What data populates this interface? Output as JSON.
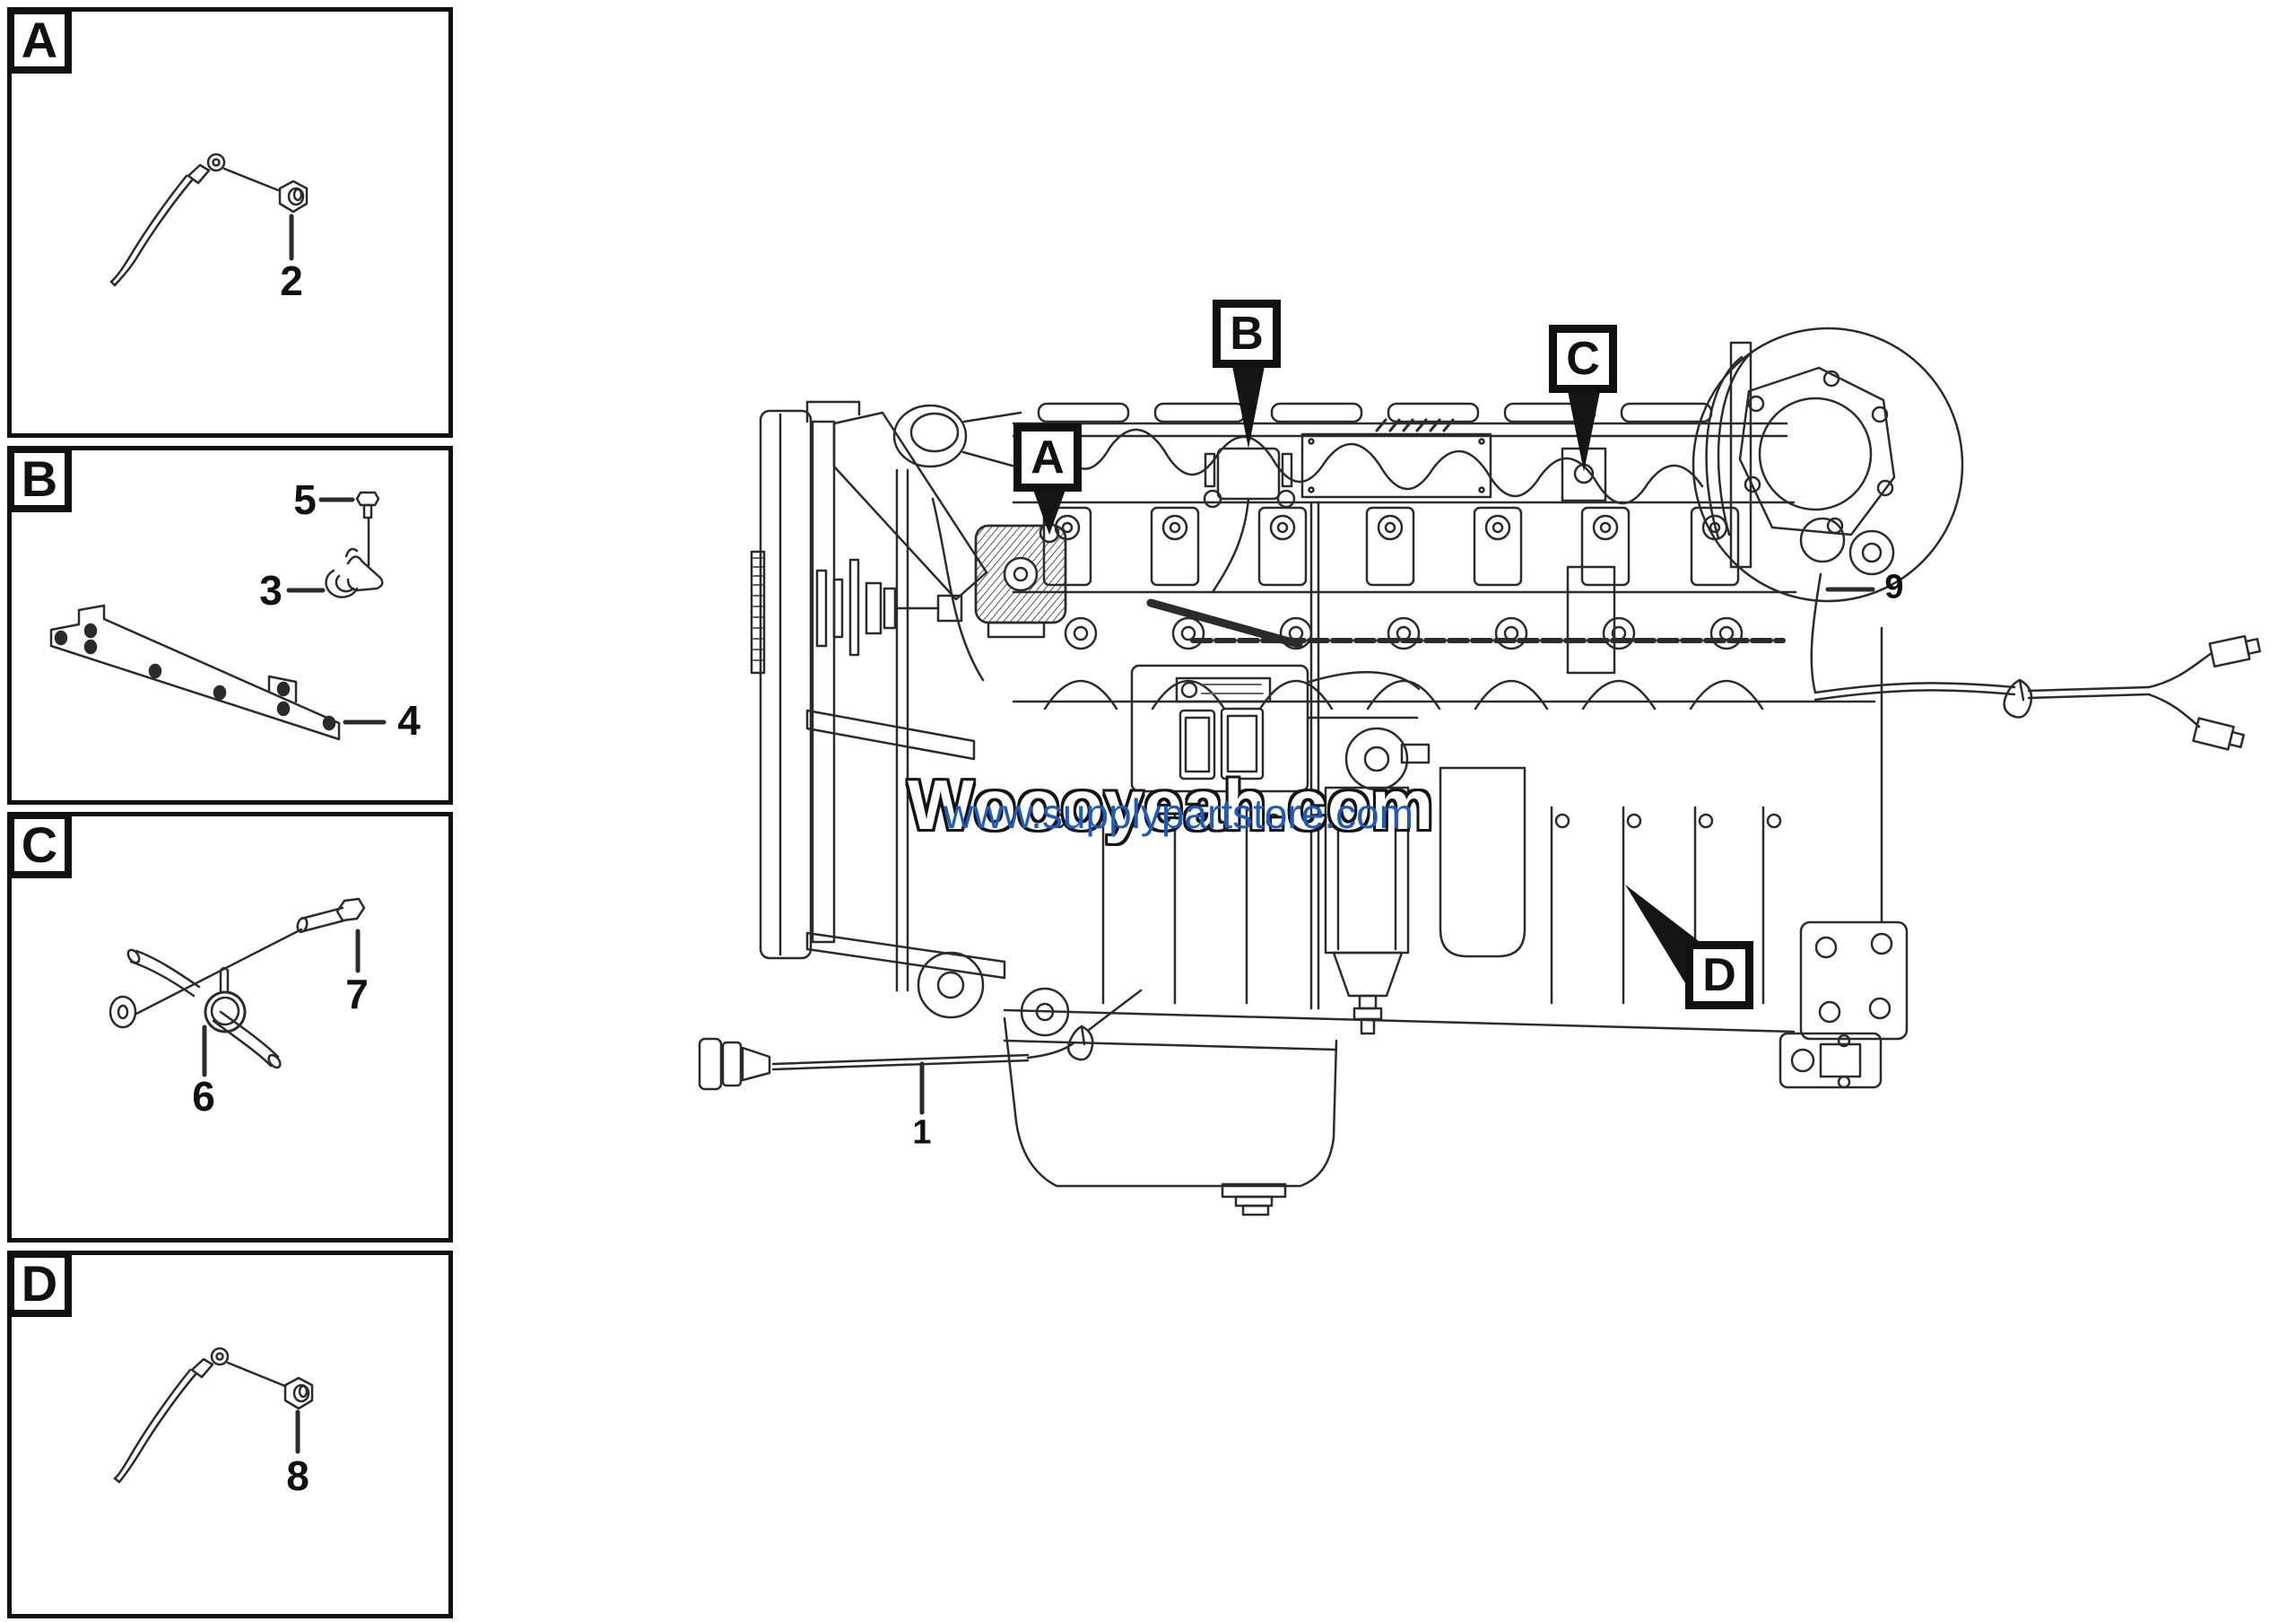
{
  "page": {
    "background": "#ffffff",
    "line_color": "#231f20"
  },
  "panels": [
    {
      "label": "A",
      "parts": [
        {
          "number": "2",
          "name": "ground-wire-and-nut"
        }
      ]
    },
    {
      "label": "B",
      "parts": [
        {
          "number": "5",
          "name": "flange-bolt"
        },
        {
          "number": "3",
          "name": "wiring-clip"
        },
        {
          "number": "4",
          "name": "harness-bracket-strip"
        }
      ]
    },
    {
      "label": "C",
      "parts": [
        {
          "number": "7",
          "name": "hex-bolt"
        },
        {
          "number": "6",
          "name": "washer-and-p-clamp"
        }
      ]
    },
    {
      "label": "D",
      "parts": [
        {
          "number": "8",
          "name": "ground-wire-and-nut"
        }
      ]
    }
  ],
  "engine": {
    "callouts": [
      "A",
      "B",
      "C",
      "D"
    ],
    "labels": [
      {
        "number": "1",
        "name": "main-wiring-harness"
      },
      {
        "number": "9",
        "name": "rear-harness"
      }
    ]
  },
  "watermark": {
    "outlined_text": "Woooyeah.com",
    "blue_text": "www.supplypartstore.com",
    "blue_color": "#1d5bc4"
  }
}
